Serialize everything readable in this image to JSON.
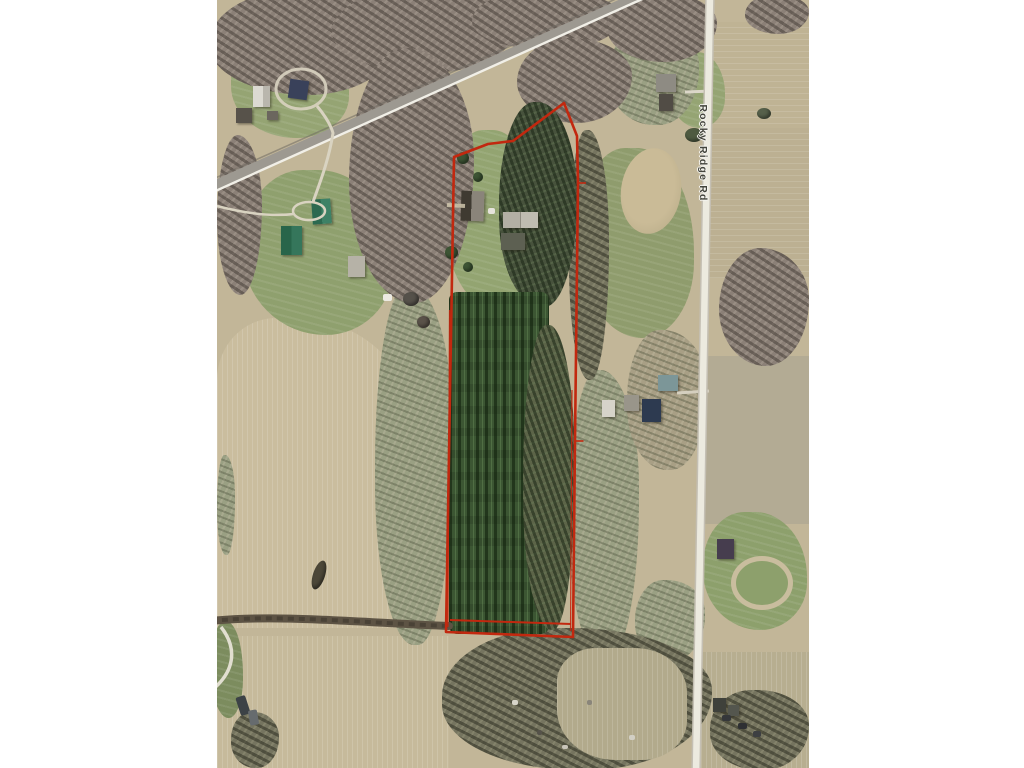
{
  "map": {
    "road_label": "Rocky Ridge Rd",
    "overlay": {
      "parcel_outline_color": "#c2280f",
      "parcel_outline_style": "double-line polygon"
    },
    "palette": {
      "page_background": "#ffffff",
      "field_tan": "#c6ba9b",
      "forest_grey": "#8b8077",
      "conifer_green": "#3c5633",
      "grass_green": "#95a473",
      "road_surface_white": "#eceadf",
      "highway_asphalt": "#9d9991",
      "hedgerow_dark": "#5d5344"
    }
  }
}
